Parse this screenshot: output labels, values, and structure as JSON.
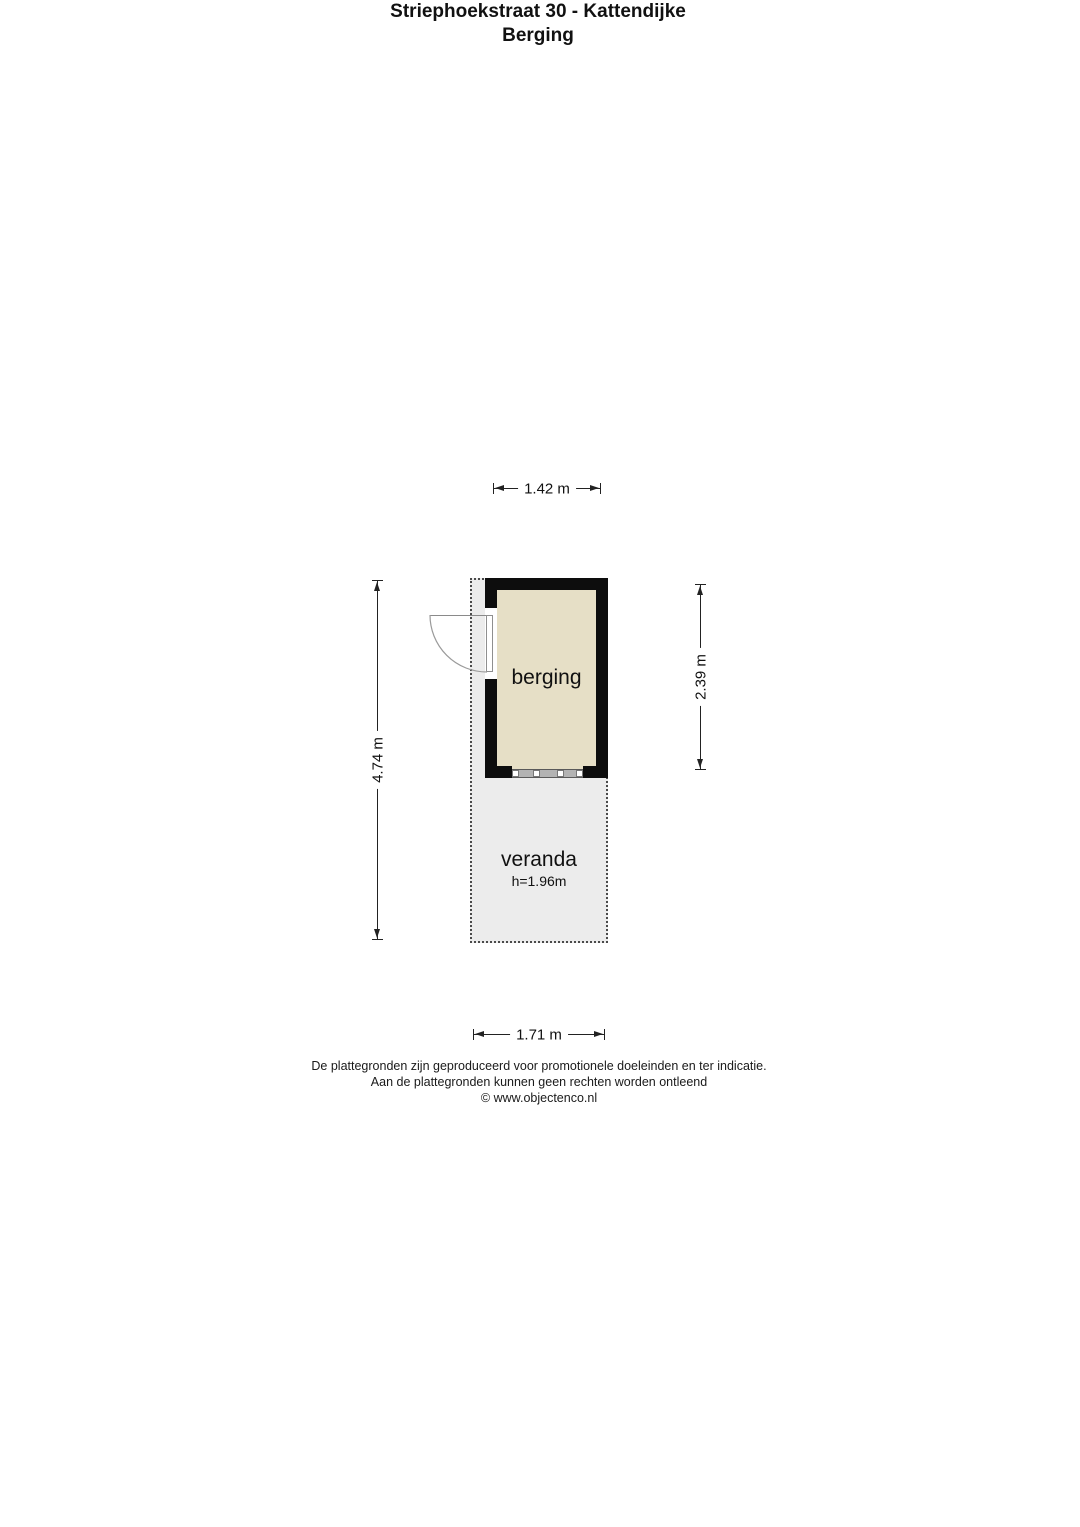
{
  "title": {
    "line1": "Striephoekstraat 30 - Kattendijke",
    "line2": "Berging"
  },
  "plan": {
    "rooms": {
      "berging": {
        "label": "berging"
      },
      "veranda": {
        "label": "veranda",
        "height_note": "h=1.96m"
      }
    },
    "dimensions": {
      "width_top": "1.42 m",
      "height_left": "4.74 m",
      "height_right": "2.39 m",
      "width_bottom": "1.71 m"
    },
    "colors": {
      "wall": "#0d0d0d",
      "berging_fill": "#e6dfc6",
      "veranda_fill": "#ececec",
      "window_frame": "#b3b3b3",
      "dimension_line": "#222222",
      "door_line": "#9a9a9a"
    }
  },
  "footer": {
    "line1": "De plattegronden zijn geproduceerd voor promotionele doeleinden en ter indicatie.",
    "line2": "Aan de plattegronden kunnen geen rechten worden ontleend",
    "line3": "© www.objectenco.nl"
  }
}
